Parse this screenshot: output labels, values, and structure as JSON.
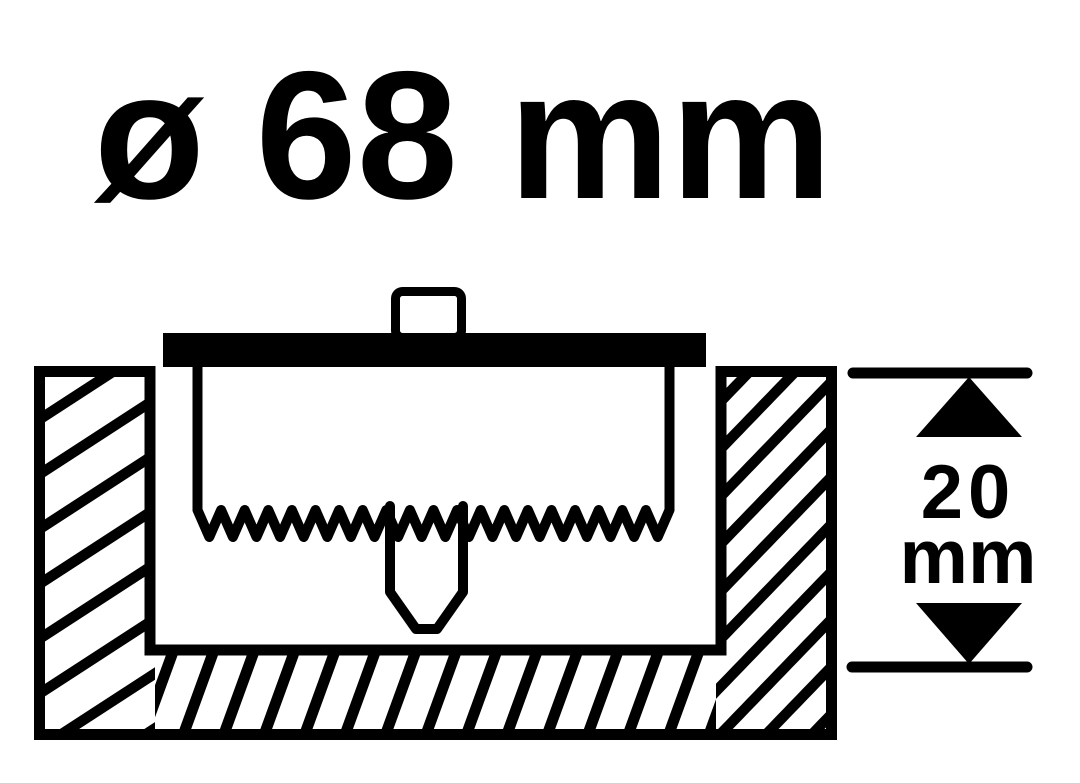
{
  "diagram": {
    "title": "ø 68 mm",
    "depth": {
      "value": "20",
      "unit": "mm"
    },
    "colors": {
      "ink": "#000000",
      "background": "#ffffff"
    }
  }
}
